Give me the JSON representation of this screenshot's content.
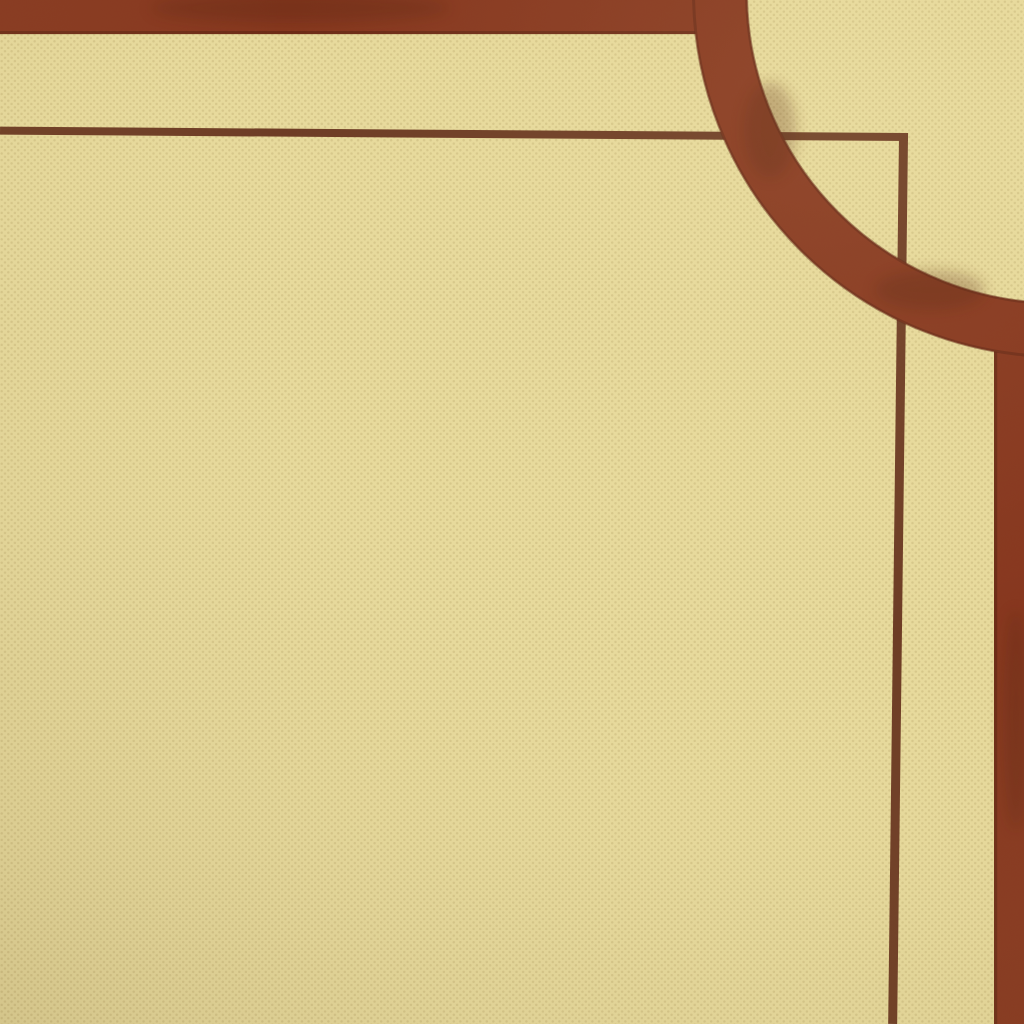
{
  "scene": {
    "type": "photo-closeup",
    "subject": "corner of a printed card with decorative brown border on cream halftone paper",
    "colors": {
      "paper": "#e9dc9e",
      "paper_dot": "#c8b77a",
      "paper_bright": "#f3e9b4",
      "ink_band": "#87371f",
      "ink_band_edge": "#5d2413",
      "ink_mottle": "#54200f",
      "ink_thin_line": "#6e3c25",
      "vignette_edge": "#4a2e0c"
    },
    "geometry_note": "thick top band and right band joined by quarter-circle arc; thin inner rule with square corner crossing under the arc"
  }
}
